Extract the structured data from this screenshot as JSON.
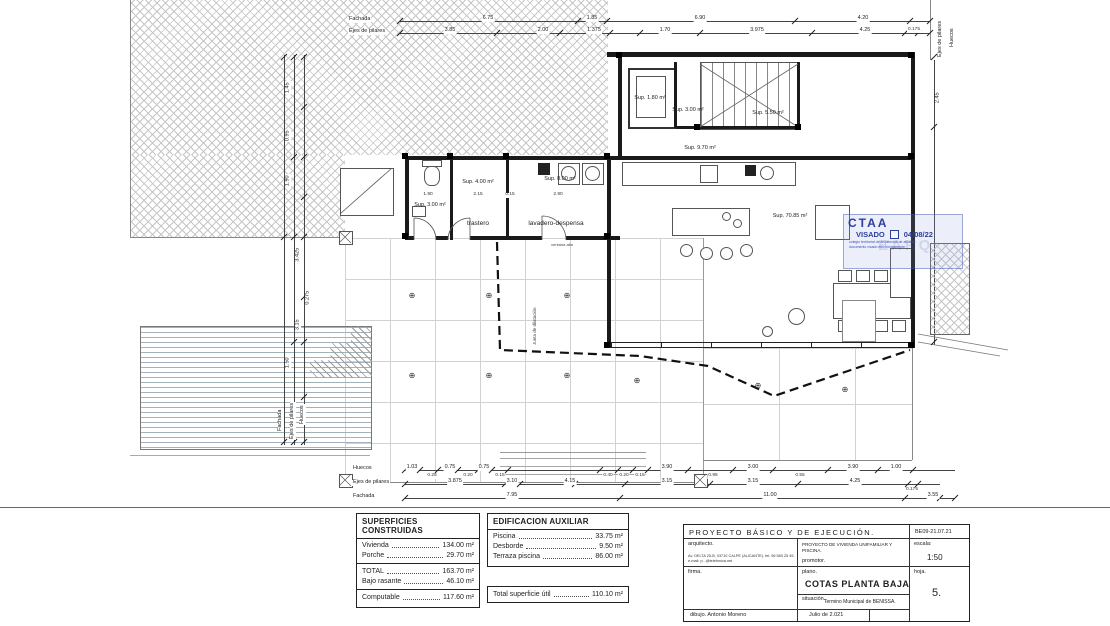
{
  "plan": {
    "room_labels": {
      "bath_sup": "Sup. 3.00 m²",
      "trastero_sup": "Sup. 4.00 m²",
      "trastero_name": "trastero",
      "lavadero_sup": "Sup. 8.00 m²",
      "lavadero_name": "lavadero-despensa",
      "elevator_sup": "Sup. 1.80 m²",
      "hall_sup": "Sup. 3.00 m²",
      "stairs_sup": "Sup. 5.50 m²",
      "corridor_sup": "Sup. 9.70 m²",
      "living_sup": "Sup. 70.85 m²",
      "ventana_alta": "ventana alta",
      "junta": "Junta de dilatación"
    },
    "axis": {
      "fachada": "Fachada",
      "ejes": "Ejes de pilares",
      "huecos": "Huecos"
    },
    "dims": {
      "top_fachada": [
        "6.75",
        "1.85",
        "6.90",
        "4.20"
      ],
      "top_ejes": [
        "3.85",
        "2.00",
        "1.375",
        "1.70",
        "3.975",
        "4.25",
        "0.175"
      ],
      "bottom_huecos": [
        "1.03",
        "0.25",
        "0.75",
        "0.20",
        "0.75",
        "0.15",
        "0.40",
        "0.20",
        "0.15",
        "3.90",
        "0.95",
        "3.00",
        "0.55",
        "3.90",
        "1.00"
      ],
      "bottom_ejes": [
        "3.875",
        "3.10",
        "4.15",
        "3.15",
        "3.15",
        "4.25",
        "0.175"
      ],
      "bottom_fachada": [
        "7.95",
        "11.00",
        "3.55"
      ],
      "left": [
        "1.45",
        "0.95",
        "1.90",
        "3.425",
        "3.15",
        "0.275",
        "1.50"
      ],
      "right": [
        "2.45"
      ],
      "interior": [
        "1.90",
        "2.15",
        "0.15",
        "2.90"
      ]
    }
  },
  "stamp": {
    "org": "CTAA",
    "visado": "VISADO",
    "fecha": "04/08/22",
    "watermark": "EARQ",
    "line1": "colegio territorial de arquitectos de alicante",
    "line2": "documento visado electrónicamente"
  },
  "tables": {
    "superficies": {
      "title": "SUPERFICIES CONSTRUIDAS",
      "rows": [
        {
          "label": "Vivienda",
          "value": "134.00 m²"
        },
        {
          "label": "Porche",
          "value": "29.70 m²"
        },
        {
          "label": "TOTAL",
          "value": "163.70 m²"
        },
        {
          "label": "Bajo rasante",
          "value": "46.10 m²"
        },
        {
          "label": "Computable",
          "value": "117.60 m²"
        }
      ]
    },
    "auxiliar": {
      "title": "EDIFICACION AUXILIAR",
      "rows": [
        {
          "label": "Piscina",
          "value": "33.75 m²"
        },
        {
          "label": "Desborde",
          "value": "9.50 m²"
        },
        {
          "label": "Terraza piscina",
          "value": "86.00 m²"
        }
      ]
    },
    "util": {
      "label": "Total superficie útil",
      "value": "110.10 m²"
    }
  },
  "titleblock": {
    "project": "PROYECTO BÁSICO Y DE EJECUCIÓN.",
    "ref": "BE09-21.07.21",
    "arquitecto_label": "arquitecto.",
    "address_line1": "Av. DELTA 25-B, 03710 CALPE (ALICANTE). tel. 96 583 25 45.",
    "address_line2": "e-mail: p...@telefonica.net",
    "project_desc": "PROYECTO DE VIVIENDA UNIFAMILIAR Y PISCINA.",
    "promotor_label": "promotor.",
    "escala_label": "escala:",
    "escala_value": "1:50",
    "firma_label": "firma.",
    "plano_label": "plano.",
    "plano_value": "COTAS PLANTA BAJA",
    "situacion_label": "situación.",
    "situacion_value": "Termino Municipal de BENISSA.",
    "hoja_label": "hoja.",
    "hoja_value": "5.",
    "dibujo": "dibujo. Antonio Moreno",
    "fecha": "Julio de 2.021"
  }
}
